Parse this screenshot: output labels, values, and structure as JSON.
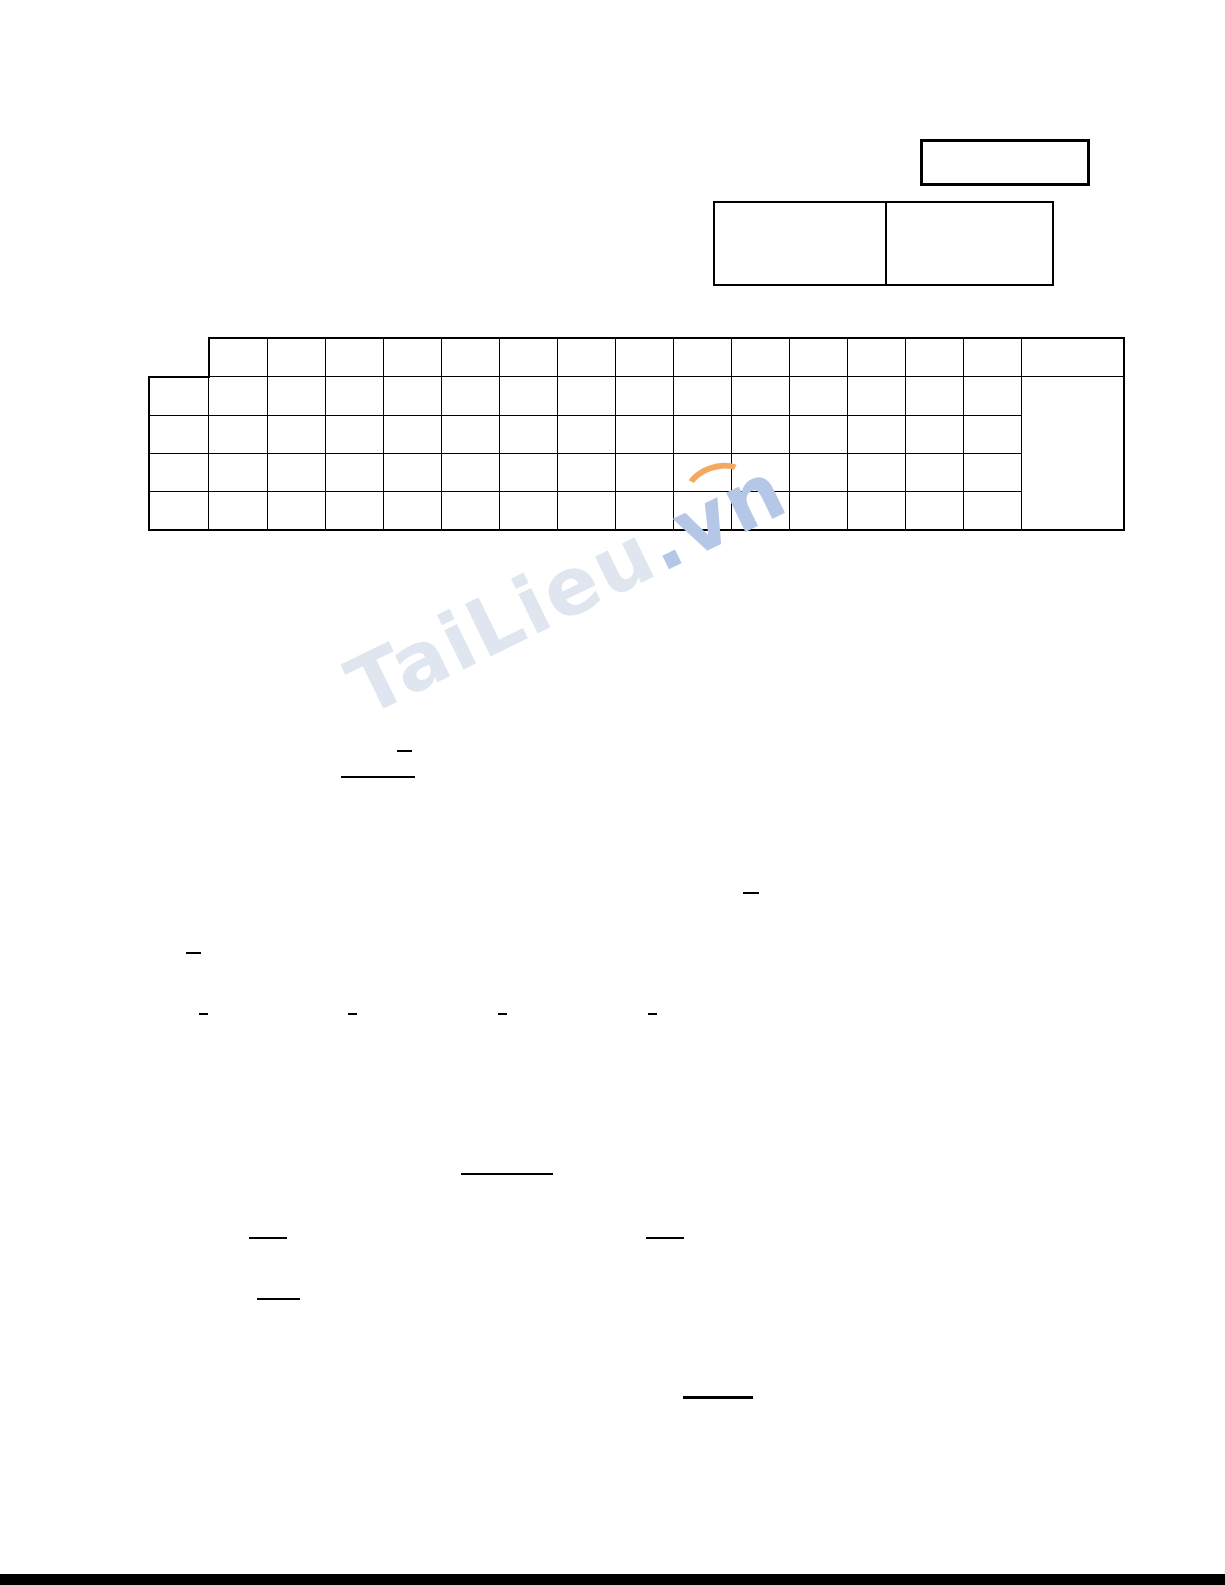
{
  "page": {
    "background_color": "#ffffff",
    "ink_color": "#000000"
  },
  "watermark": {
    "text_main": "TaiLieu",
    "text_suffix": ".vn",
    "color_main": "#dfe6ef",
    "color_suffix": "#b5c7e6",
    "swoosh_color": "#f4a960"
  },
  "tables": {
    "answer_grid": {
      "header_columns": 14,
      "data_rows": 4,
      "has_left_label_column": true,
      "has_merged_right_column": true
    }
  }
}
